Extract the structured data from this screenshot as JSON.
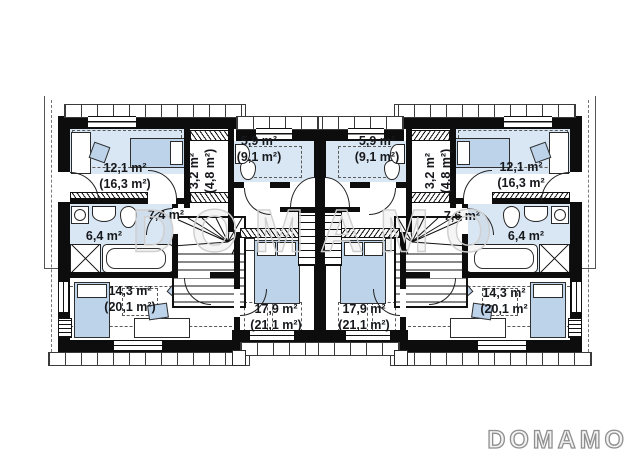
{
  "watermark": {
    "text": "DOMAMO"
  },
  "brand": {
    "logo_text": "DOMAMO"
  },
  "colors": {
    "wall": "#0d0d0d",
    "room_fill": "#ffffff",
    "highlight_blue": "#d9e7f4",
    "furniture_blue": "#bcd3ea",
    "watermark_gray": "#cfcfcf",
    "logo_gray": "#8f8f8f"
  },
  "units": {
    "left": {
      "bedroom_top": {
        "area": "12,1 m²",
        "attic_area": "(16,3 m²)"
      },
      "wardrobe": {
        "area": "3,2 m²",
        "attic_area": "(4,8 m²)"
      },
      "bathroom_top": {
        "area": "5,9 m²",
        "attic_area": "(9,1 m²)"
      },
      "hall": {
        "area": "7,4 m²"
      },
      "bathroom": {
        "area": "6,4 m²"
      },
      "room_bottom": {
        "area": "14,3 m²",
        "attic_area": "(20,1 m²)"
      },
      "bedroom_bottom": {
        "area": "17,9 m²",
        "attic_area": "(21,1 m²)"
      }
    },
    "right": {
      "bathroom_top": {
        "area": "5,9 m²",
        "attic_area": "(9,1 m²)"
      },
      "wardrobe": {
        "area": "3,2 m²",
        "attic_area": "(4,8 m²)"
      },
      "bedroom_top": {
        "area": "12,1 m²",
        "attic_area": "(16,3 m²"
      },
      "hall": {
        "area": "7,6 m²"
      },
      "bathroom": {
        "area": "6,4 m²"
      },
      "bedroom_bottom": {
        "area": "17,9 m²",
        "attic_area": "(21,1 m²)"
      },
      "room_bottom": {
        "area": "14,3 m²",
        "attic_area": "(20,1 m²"
      }
    }
  }
}
